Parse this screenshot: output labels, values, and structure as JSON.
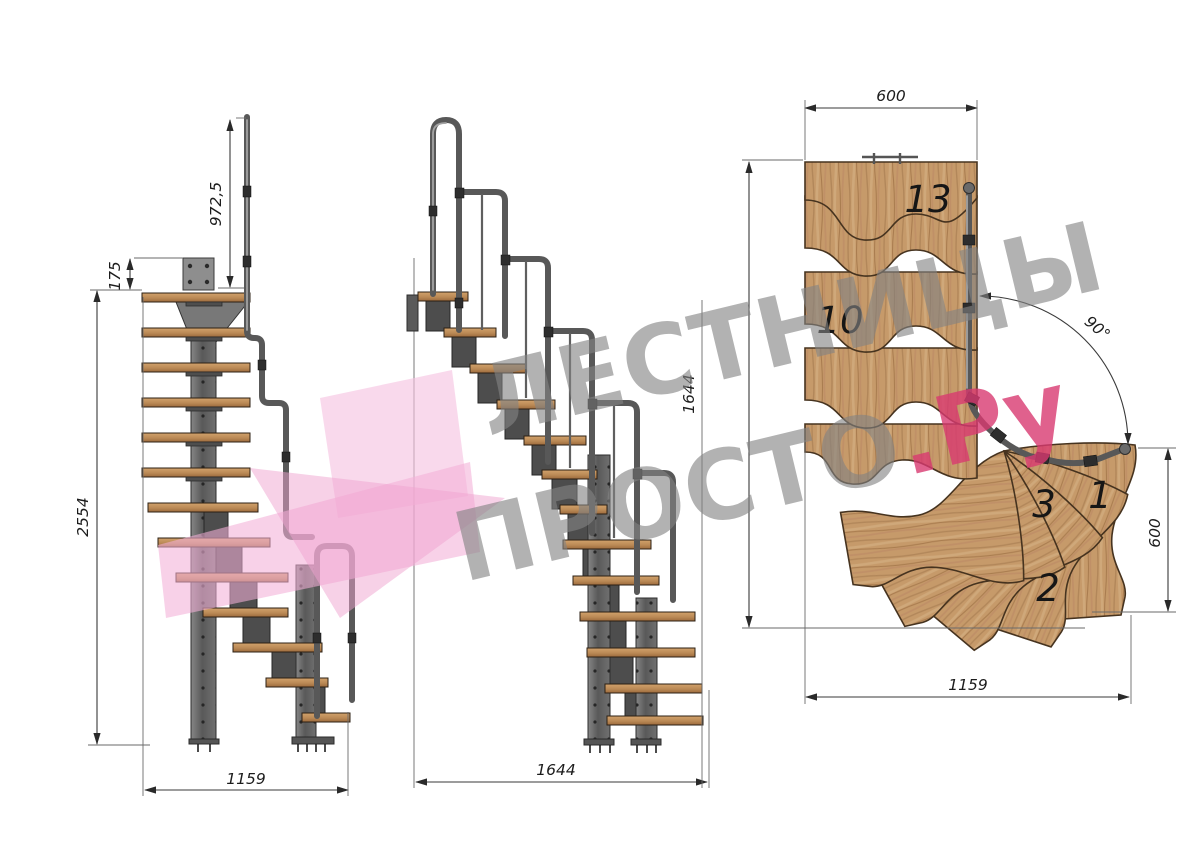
{
  "drawing": {
    "title": "modular staircase technical drawing, three views",
    "side_view": {
      "dims": {
        "rail_height": "972,5",
        "top_plate": "175",
        "total_height": "2554",
        "run": "1159"
      }
    },
    "front_view": {
      "dims": {
        "run": "1644"
      }
    },
    "plan_view": {
      "dims": {
        "landing_width": "600",
        "overall_depth": "1644",
        "entry_width": "600",
        "overall_run": "1159",
        "turn_angle": "90°"
      },
      "steps": {
        "top": "13",
        "mid": "10",
        "third": "3",
        "first": "1",
        "second": "2"
      }
    }
  },
  "watermark": {
    "line1": "ЛЕСТНИЦЫ",
    "line2": "ПРОСТО",
    "domain": ".Ру"
  },
  "palette": {
    "wood": "#c69a6a",
    "wood_dark": "#a9753f",
    "steel": "#6b6b6b",
    "rail": "#585858",
    "pink": "#f3b0d7",
    "red": "#d83a70",
    "dim_line": "#3a3a3a"
  }
}
